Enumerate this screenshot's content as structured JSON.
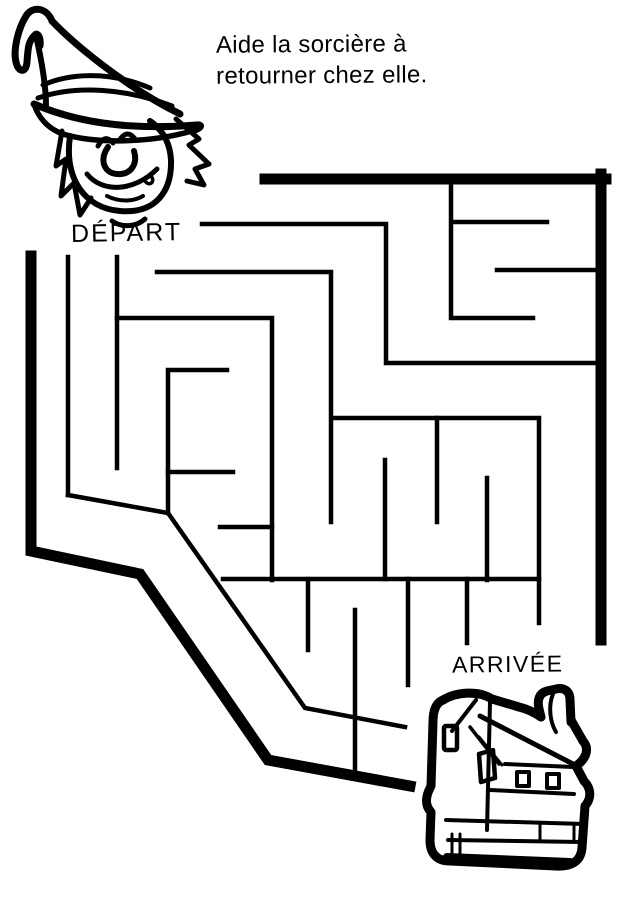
{
  "page": {
    "background": "#ffffff",
    "ink": "#000000"
  },
  "title": {
    "line1": "Aide la sorcière à",
    "line2": "retourner chez elle."
  },
  "labels": {
    "start": "DÉPART",
    "finish": "ARRIVÉE"
  },
  "illustrations": {
    "top_left": "witch-head-with-pointed-hat",
    "bottom_right": "cartoon-house"
  },
  "maze": {
    "thick_walls": [
      [
        [
          265,
          179
        ],
        [
          606,
          179
        ]
      ],
      [
        [
          601,
          174
        ],
        [
          601,
          640
        ]
      ],
      [
        [
          31,
          256
        ],
        [
          31,
          551
        ],
        [
          140,
          574
        ],
        [
          268,
          760
        ],
        [
          410,
          786
        ]
      ]
    ],
    "thin_walls": [
      [
        [
          202,
          224
        ],
        [
          386,
          224
        ],
        [
          386,
          363
        ],
        [
          599,
          363
        ]
      ],
      [
        [
          455,
          222
        ],
        [
          547,
          222
        ]
      ],
      [
        [
          451,
          184
        ],
        [
          451,
          318
        ],
        [
          533,
          318
        ]
      ],
      [
        [
          497,
          270
        ],
        [
          599,
          270
        ]
      ],
      [
        [
          157,
          272
        ],
        [
          331,
          272
        ],
        [
          331,
          522
        ]
      ],
      [
        [
          117,
          318
        ],
        [
          272,
          318
        ],
        [
          272,
          580
        ]
      ],
      [
        [
          68,
          257
        ],
        [
          68,
          495
        ]
      ],
      [
        [
          117,
          257
        ],
        [
          117,
          468
        ]
      ],
      [
        [
          227,
          370
        ],
        [
          168,
          370
        ],
        [
          168,
          513
        ]
      ],
      [
        [
          168,
          472
        ],
        [
          233,
          472
        ]
      ],
      [
        [
          220,
          527
        ],
        [
          272,
          527
        ]
      ],
      [
        [
          68,
          495
        ],
        [
          168,
          513
        ],
        [
          305,
          708
        ],
        [
          405,
          727
        ]
      ],
      [
        [
          333,
          418
        ],
        [
          539,
          418
        ],
        [
          539,
          623
        ]
      ],
      [
        [
          437,
          418
        ],
        [
          437,
          522
        ]
      ],
      [
        [
          487,
          478
        ],
        [
          487,
          580
        ]
      ],
      [
        [
          385,
          460
        ],
        [
          385,
          579
        ]
      ],
      [
        [
          223,
          579
        ],
        [
          539,
          579
        ]
      ],
      [
        [
          308,
          579
        ],
        [
          308,
          650
        ]
      ],
      [
        [
          355,
          610
        ],
        [
          355,
          775
        ]
      ],
      [
        [
          408,
          579
        ],
        [
          408,
          685
        ]
      ],
      [
        [
          467,
          579
        ],
        [
          467,
          643
        ]
      ]
    ]
  }
}
